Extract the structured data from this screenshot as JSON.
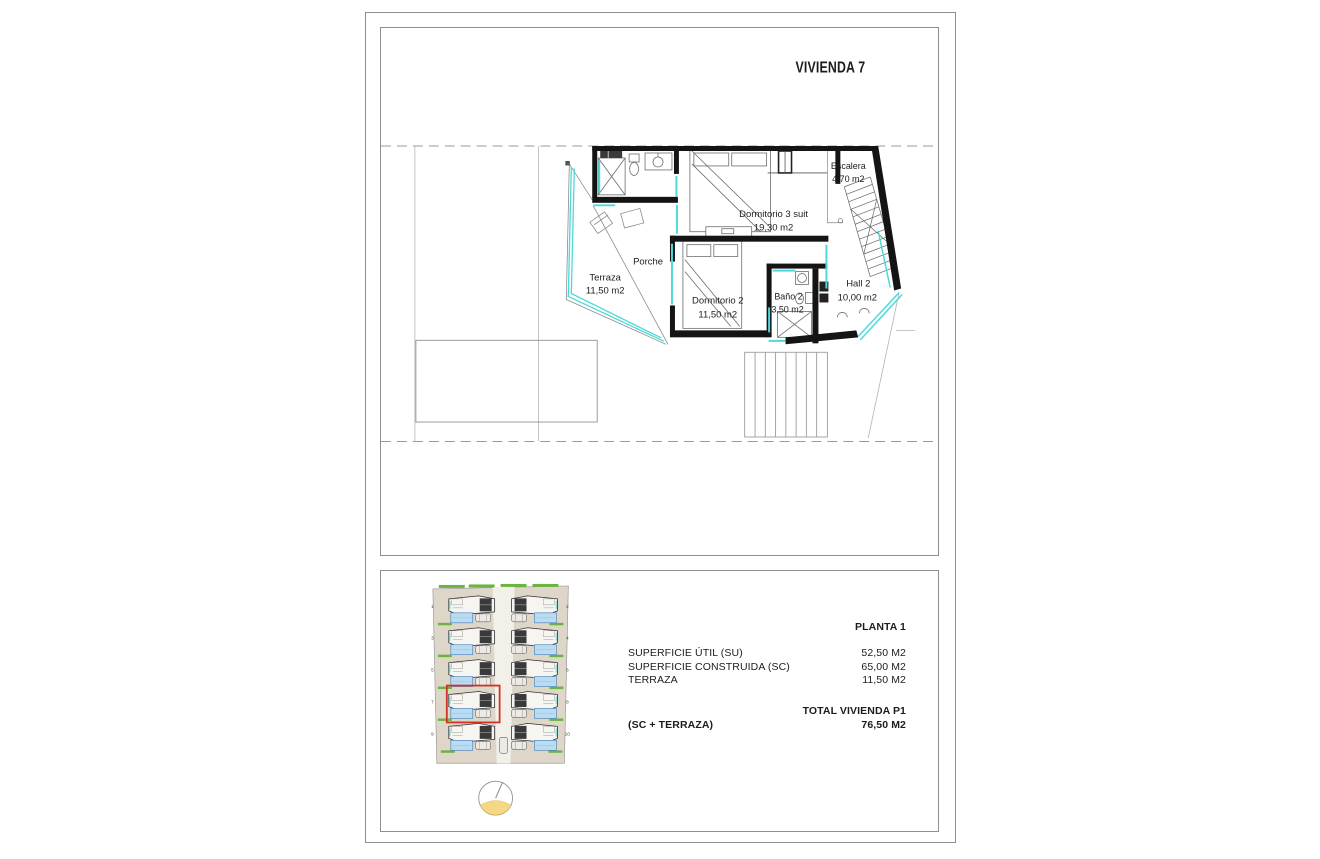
{
  "page": {
    "title": "VIVIENDA 7"
  },
  "floor_plan": {
    "rooms": {
      "escalera": {
        "name": "Escalera",
        "area": "4,70 m2"
      },
      "dormitorio3": {
        "name": "Dormitorio 3 suit",
        "area": "19,30 m2"
      },
      "porche": {
        "name": "Porche"
      },
      "terraza": {
        "name": "Terraza",
        "area": "11,50 m2"
      },
      "dormitorio2": {
        "name": "Dormitorio 2",
        "area": "11,50 m2"
      },
      "bano2": {
        "name": "Baño 2",
        "area": "3,50 m2"
      },
      "hall2": {
        "name": "Hall 2",
        "area": "10,00 m2"
      }
    }
  },
  "site_plan": {
    "left_unit_numbers": [
      "1",
      "3",
      "5",
      "7",
      "9"
    ],
    "right_unit_numbers": [
      "2",
      "4",
      "6",
      "8",
      "10"
    ],
    "highlighted_unit": "7"
  },
  "summary": {
    "floor_label": "PLANTA 1",
    "rows": [
      {
        "label": "SUPERFICIE ÚTIL (SU)",
        "value": "52,50 M2"
      },
      {
        "label": "SUPERFICIE CONSTRUIDA (SC)",
        "value": "65,00 M2"
      },
      {
        "label": "TERRAZA",
        "value": "11,50 M2"
      }
    ],
    "total_label": "TOTAL VIVIENDA P1",
    "total_sublabel": "(SC + TERRAZA)",
    "total_value": "76,50 M2"
  },
  "colors": {
    "glazing": "#4ed9d9",
    "wall": "#141414",
    "highlight": "#cf3326",
    "pool": "#badcf2",
    "hedge": "#6cb33f",
    "parcel": "#ded6c8",
    "compass_sun": "#f6d884"
  }
}
